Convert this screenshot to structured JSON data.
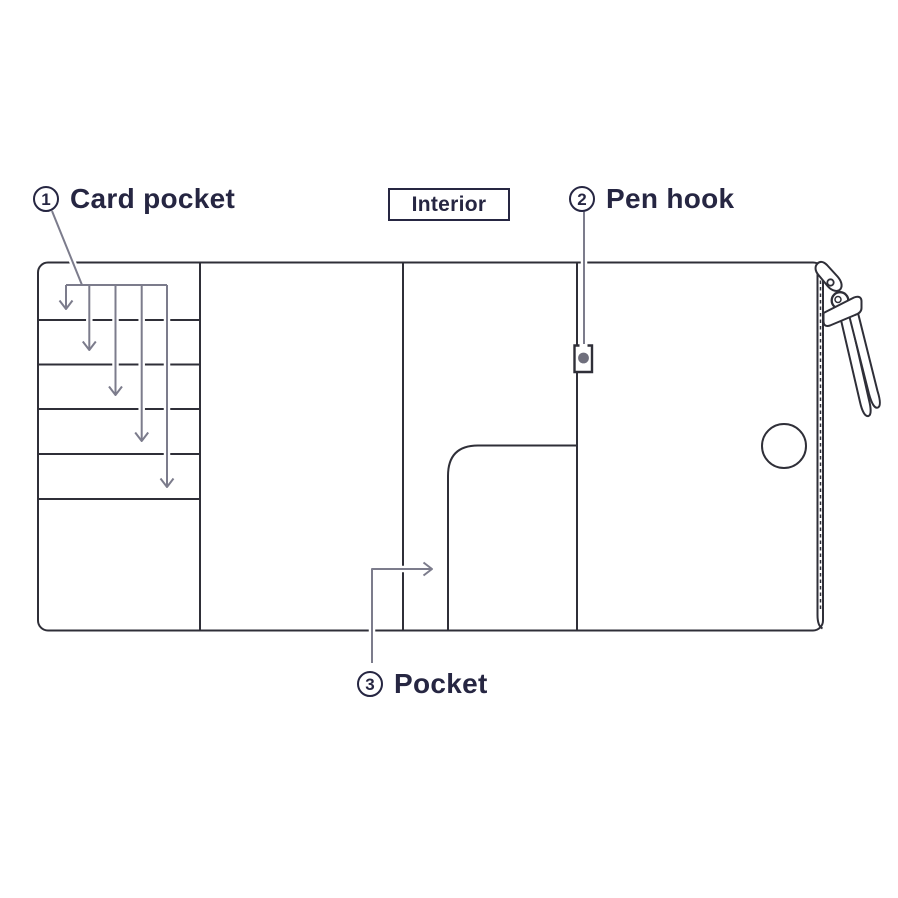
{
  "interior_tag": {
    "label": "Interior"
  },
  "callouts": {
    "card_pocket": {
      "number": "1",
      "label": "Card pocket"
    },
    "pen_hook": {
      "number": "2",
      "label": "Pen hook"
    },
    "pocket": {
      "number": "3",
      "label": "Pocket"
    }
  },
  "diagram": {
    "type": "organizer-interior-diagram",
    "panel_count": 4,
    "card_slot_count": 5,
    "card_pocket_arrow_count": 5,
    "features": [
      "card-pocket-panel",
      "pen-hook",
      "inner-pocket",
      "zipper-edge",
      "thumb-hole",
      "zipper-pull-tassel"
    ]
  },
  "colors": {
    "ink": "#262642",
    "outline": "#2f2f38",
    "arrow": "#7c7c8c",
    "pen_hook_dot": "#6f6f7d",
    "background": "#ffffff"
  }
}
